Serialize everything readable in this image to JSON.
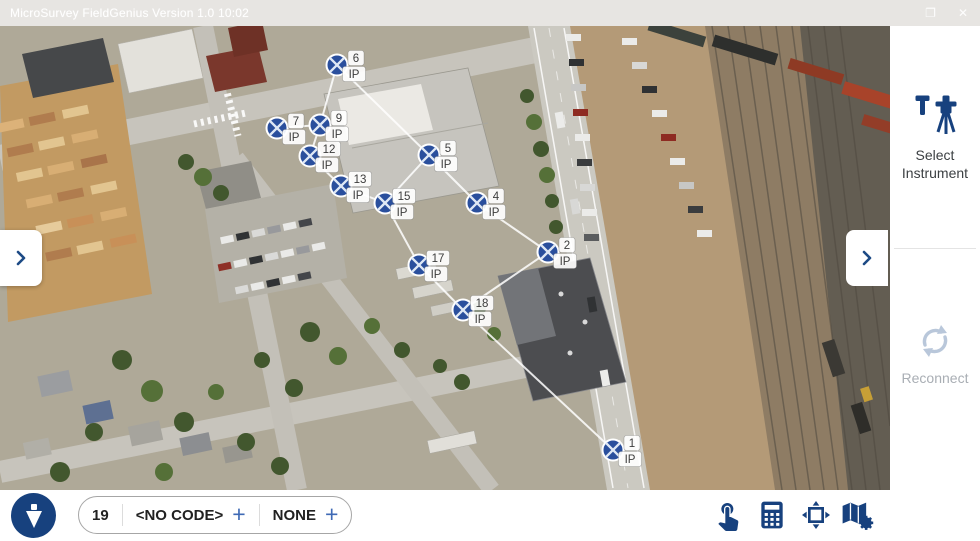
{
  "window": {
    "title": "MicroSurvey FieldGenius Version 1.0 10:02",
    "maximize_glyph": "❐",
    "close_glyph": "✕"
  },
  "right_panel": {
    "select_instrument_label": "Select Instrument",
    "reconnect_label": "Reconnect",
    "expand_chevron_icon": "chevron-right"
  },
  "left_panel": {
    "expand_chevron_icon": "chevron-right"
  },
  "bottom_toolbar": {
    "next_point_number": "19",
    "code_value": "<NO CODE>",
    "code_add_label": "+",
    "description_value": "NONE",
    "description_add_label": "+",
    "icons": [
      "plumb-bob",
      "touch",
      "calculator",
      "zoom-extents",
      "map-settings"
    ]
  },
  "map": {
    "marker_color": "#2a4f9d",
    "marker_cross_color": "#dfe8f5",
    "line_color": "#ffffff",
    "point_code": "IP",
    "points": [
      {
        "id": "1",
        "code": "IP",
        "x": 613,
        "y": 424
      },
      {
        "id": "2",
        "code": "IP",
        "x": 548,
        "y": 226
      },
      {
        "id": "4",
        "code": "IP",
        "x": 477,
        "y": 177
      },
      {
        "id": "5",
        "code": "IP",
        "x": 429,
        "y": 129
      },
      {
        "id": "6",
        "code": "IP",
        "x": 337,
        "y": 39
      },
      {
        "id": "7",
        "code": "IP",
        "x": 277,
        "y": 102
      },
      {
        "id": "9",
        "code": "IP",
        "x": 320,
        "y": 99
      },
      {
        "id": "12",
        "code": "IP",
        "x": 310,
        "y": 130
      },
      {
        "id": "13",
        "code": "IP",
        "x": 341,
        "y": 160
      },
      {
        "id": "15",
        "code": "IP",
        "x": 385,
        "y": 177
      },
      {
        "id": "17",
        "code": "IP",
        "x": 419,
        "y": 239
      },
      {
        "id": "18",
        "code": "IP",
        "x": 463,
        "y": 284
      }
    ],
    "lines": [
      [
        "7",
        "9"
      ],
      [
        "9",
        "12"
      ],
      [
        "12",
        "13"
      ],
      [
        "13",
        "15"
      ],
      [
        "15",
        "17"
      ],
      [
        "17",
        "18"
      ],
      [
        "18",
        "1"
      ],
      [
        "6",
        "9"
      ],
      [
        "6",
        "5"
      ],
      [
        "5",
        "15"
      ],
      [
        "5",
        "4"
      ],
      [
        "4",
        "2"
      ],
      [
        "2",
        "18"
      ]
    ]
  }
}
